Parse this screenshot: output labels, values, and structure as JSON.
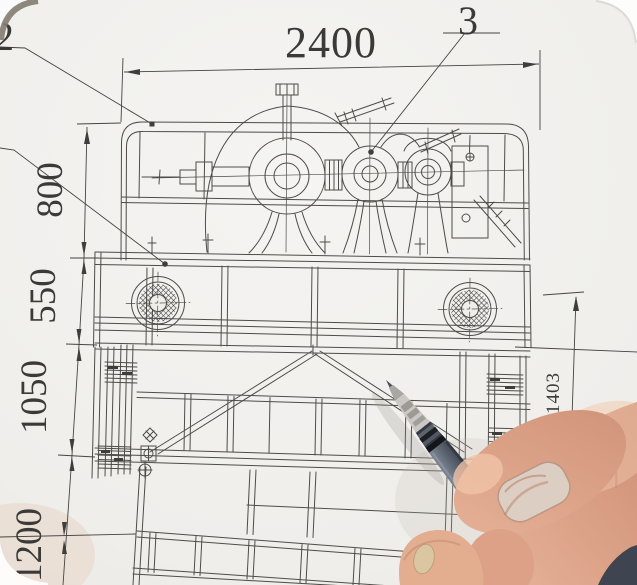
{
  "scene": {
    "description": "Photograph of a hand holding a gel pen pointing at a mechanical assembly engineering drawing",
    "paper_color": "#f2f1ee",
    "ink_color": "#4a4948",
    "pen_barrel_color": "#5c6570",
    "skin_color": "#e6b49a"
  },
  "drawing": {
    "dimensions": {
      "top": "2400",
      "left": [
        "800",
        "550",
        "1050",
        "1200"
      ],
      "right": "1403"
    },
    "callouts": {
      "upper_left": "2",
      "upper_right": "3"
    }
  }
}
